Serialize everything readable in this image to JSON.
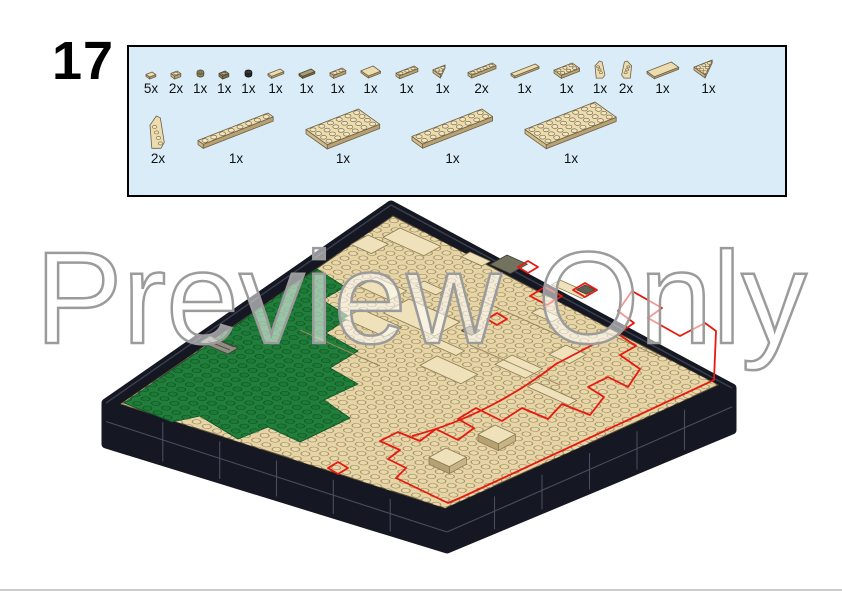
{
  "page": {
    "step_number": "17",
    "watermark_text": "Preview Only"
  },
  "colors": {
    "box_bg": "#d9ecf8",
    "box_border": "#000000",
    "plate_tan": "#e6d4a5",
    "plate_tan_light": "#efe2ba",
    "stud_line": "#8d7c54",
    "green": "#217f3b",
    "green_dark": "#0d4f22",
    "base_black": "#151722",
    "base_seam": "#474e5e",
    "highlight_red": "#e8190f",
    "dark_gray_piece": "#72725f",
    "watermark_gray": "#9b9b9b",
    "step_text": "#000000"
  },
  "parts_box": {
    "row1": [
      {
        "qty": "5x",
        "name": "tile-1x1-tan",
        "kind": "tile",
        "l": 1,
        "w": 1,
        "color": "tan"
      },
      {
        "qty": "2x",
        "name": "plate-1x1-tan",
        "kind": "plate",
        "l": 1,
        "w": 1,
        "color": "tan"
      },
      {
        "qty": "1x",
        "name": "round-plate-1x1-dark-tan",
        "kind": "round",
        "l": 1,
        "w": 1,
        "color": "darktan"
      },
      {
        "qty": "1x",
        "name": "plate-1x1-dark-tan",
        "kind": "plate",
        "l": 1,
        "w": 1,
        "color": "darktan"
      },
      {
        "qty": "1x",
        "name": "round-plate-1x1-black",
        "kind": "round",
        "l": 1,
        "w": 1,
        "color": "black"
      },
      {
        "qty": "1x",
        "name": "tile-1x2-tan",
        "kind": "tile",
        "l": 2,
        "w": 1,
        "color": "tan"
      },
      {
        "qty": "1x",
        "name": "tile-1x2-dark-tan",
        "kind": "tile",
        "l": 2,
        "w": 1,
        "color": "darktan"
      },
      {
        "qty": "1x",
        "name": "plate-1x2-tan",
        "kind": "plate",
        "l": 2,
        "w": 1,
        "color": "tan"
      },
      {
        "qty": "1x",
        "name": "tile-2x2-tan",
        "kind": "tile",
        "l": 2,
        "w": 2,
        "color": "tan"
      },
      {
        "qty": "1x",
        "name": "plate-1x3-tan",
        "kind": "plate",
        "l": 3,
        "w": 1,
        "color": "tan"
      },
      {
        "qty": "1x",
        "name": "wedge-plate-2x2-tan",
        "kind": "wedgeplate",
        "l": 2,
        "w": 2,
        "color": "tan"
      },
      {
        "qty": "2x",
        "name": "plate-1x4-tan",
        "kind": "plate",
        "l": 4,
        "w": 1,
        "color": "tan"
      },
      {
        "qty": "1x",
        "name": "tile-1x4-tan",
        "kind": "tile",
        "l": 4,
        "w": 1,
        "color": "tan"
      },
      {
        "qty": "1x",
        "name": "plate-2x3-tan",
        "kind": "plate",
        "l": 3,
        "w": 2,
        "color": "tan"
      },
      {
        "qty": "1x",
        "name": "wedge-2x4-left-tan",
        "kind": "wedge",
        "dir": "left",
        "l": 4,
        "w": 2,
        "color": "tan"
      },
      {
        "qty": "2x",
        "name": "wedge-2x4-right-tan",
        "kind": "wedge",
        "dir": "right",
        "l": 4,
        "w": 2,
        "color": "tan"
      },
      {
        "qty": "1x",
        "name": "tile-2x4-tan",
        "kind": "tile",
        "l": 4,
        "w": 2,
        "color": "tan"
      },
      {
        "qty": "1x",
        "name": "wedge-plate-3x3-tan",
        "kind": "wedgeplate",
        "l": 3,
        "w": 3,
        "color": "tan"
      }
    ],
    "row2": [
      {
        "qty": "2x",
        "name": "wedge-plate-4x2-tall-tan",
        "kind": "wedge",
        "dir": "left",
        "tall": true,
        "l": 4,
        "w": 2,
        "color": "tan"
      },
      {
        "qty": "1x",
        "name": "plate-1x8-tan",
        "kind": "plate",
        "l": 8,
        "w": 1,
        "color": "tan"
      },
      {
        "qty": "1x",
        "name": "plate-4x6-tan",
        "kind": "plate",
        "l": 6,
        "w": 4,
        "color": "tan"
      },
      {
        "qty": "1x",
        "name": "plate-2x8-tan",
        "kind": "plate",
        "l": 8,
        "w": 2,
        "color": "tan"
      },
      {
        "qty": "1x",
        "name": "plate-4x8-tan",
        "kind": "plate",
        "l": 8,
        "w": 4,
        "color": "tan"
      }
    ]
  },
  "model": {
    "view": "isometric",
    "description": "Square micro-scale LEGO terrain build on a black brick base",
    "surface": "tan studded plates with raised smooth tile patches",
    "left_region": "green studded plates",
    "new_parts_outline_color": "red",
    "base": "black stacked-brick border with rounded corners"
  }
}
